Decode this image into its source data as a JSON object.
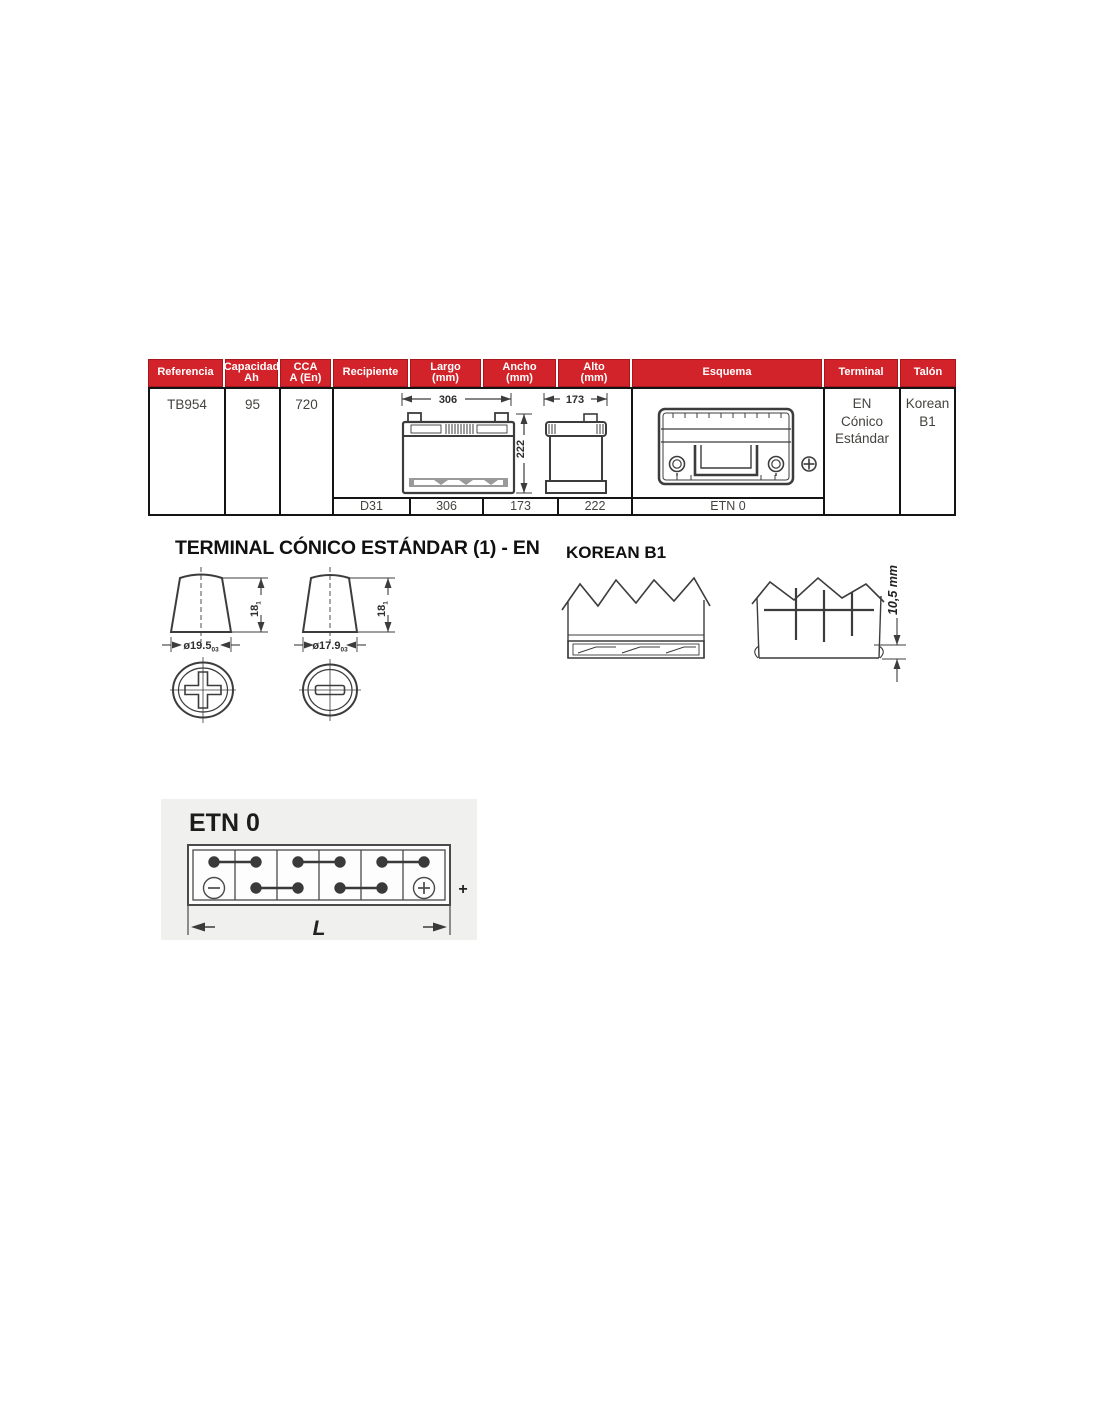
{
  "colors": {
    "header_red": "#d2232a",
    "table_line": "#141414",
    "panel_gray": "#f0f0ee",
    "drawing_line": "#3c3c3c"
  },
  "table": {
    "headers": [
      {
        "label": "Referencia"
      },
      {
        "label": "Capacidad\nAh"
      },
      {
        "label": "CCA\nA (En)"
      },
      {
        "label": "Recipiente"
      },
      {
        "label": "Largo\n(mm)"
      },
      {
        "label": "Ancho\n(mm)"
      },
      {
        "label": "Alto\n(mm)"
      },
      {
        "label": "Esquema"
      },
      {
        "label": "Terminal"
      },
      {
        "label": "Talón"
      }
    ],
    "row": {
      "referencia": "TB954",
      "capacidad": "95",
      "cca": "720",
      "terminal": "EN\nCónico\nEstándar",
      "talon": "Korean\nB1"
    },
    "drawing": {
      "front_width": "306",
      "side_width": "173",
      "height": "222"
    },
    "subrow": {
      "recipiente": "D31",
      "largo": "306",
      "ancho": "173",
      "alto": "222",
      "esquema": "ETN 0"
    }
  },
  "terminal_section": {
    "title": "TERMINAL CÓNICO ESTÁNDAR (1) - EN",
    "height_label": "18",
    "height_tolerance": "1",
    "positive": {
      "diameter": "ø19.5",
      "tolerance": "03"
    },
    "negative": {
      "diameter": "ø17.9",
      "tolerance": "03"
    }
  },
  "korean_section": {
    "title": "KOREAN B1",
    "dimension": "10,5 mm"
  },
  "etn_section": {
    "title": "ETN 0",
    "length_label": "L",
    "polarity_plus": "+"
  }
}
